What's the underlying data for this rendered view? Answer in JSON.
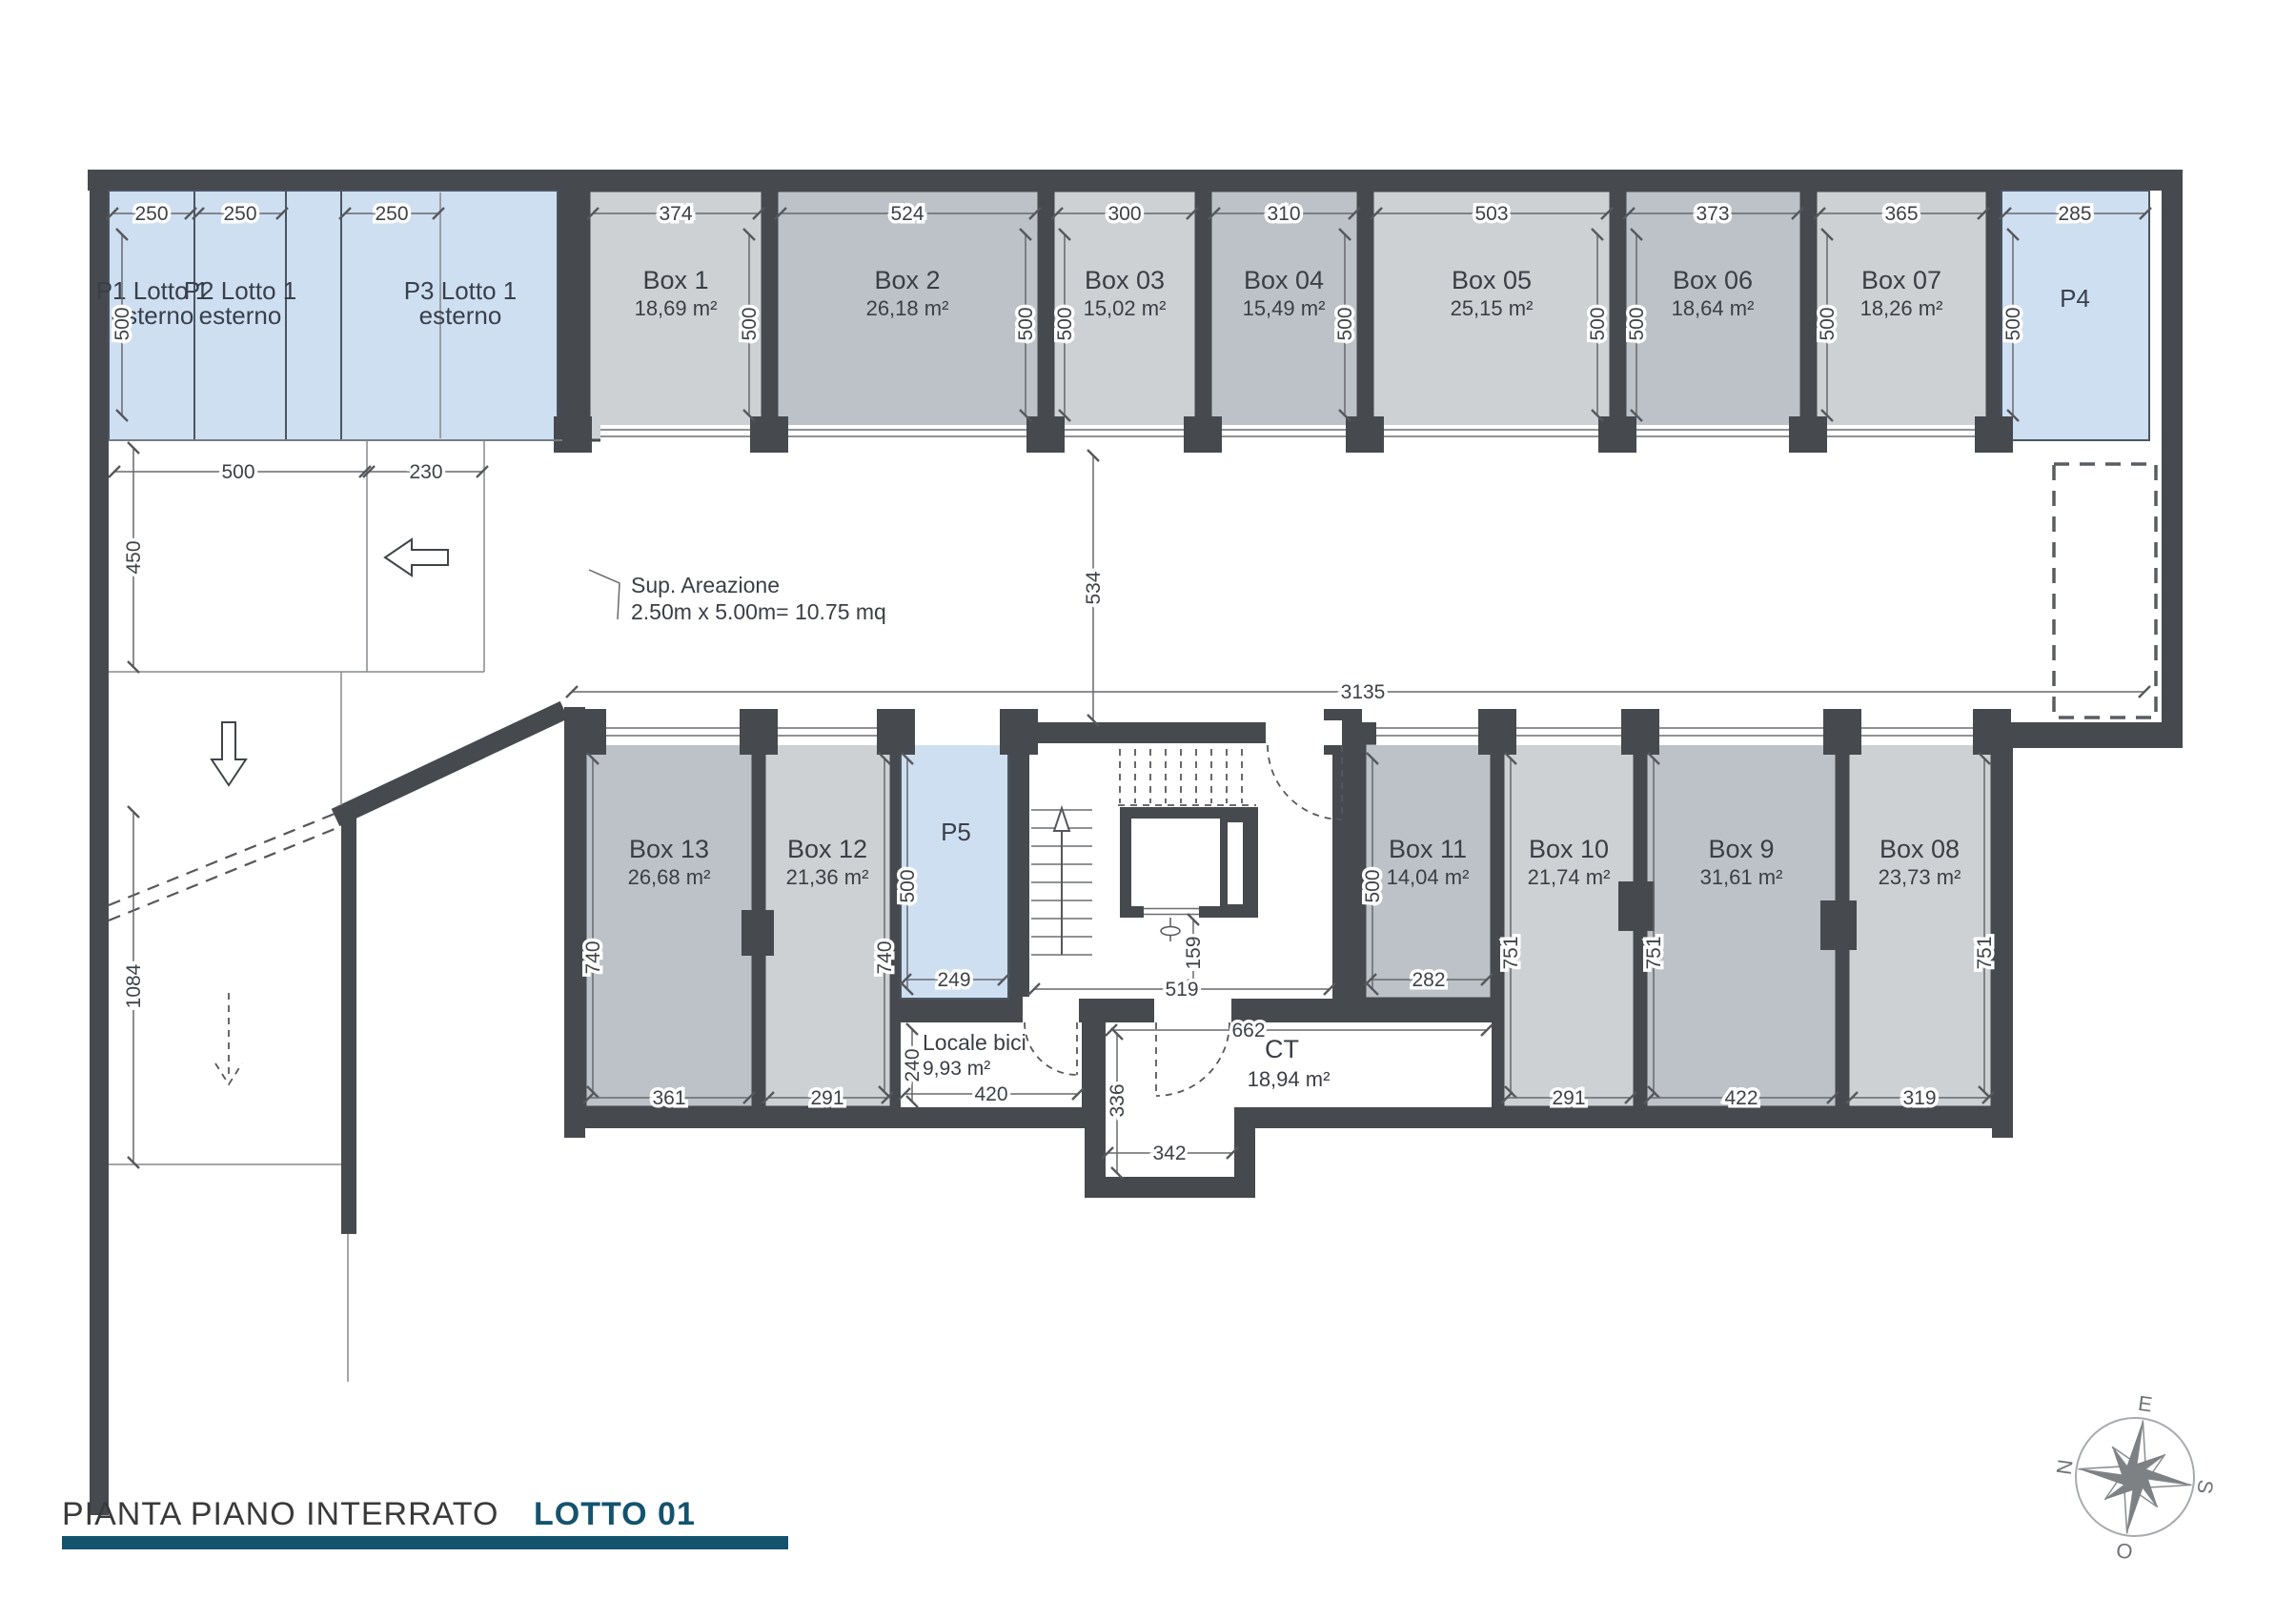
{
  "title": {
    "main": "PIANTA PIANO INTERRATO",
    "lot": "LOTTO 01"
  },
  "annotation": {
    "line1": "Sup. Areazione",
    "line2": "2.50m x 5.00m= 10.75 mq"
  },
  "compass": {
    "e": "E",
    "s": "S",
    "o": "O",
    "n": "N"
  },
  "dims": {
    "top_depth": "500",
    "left_width": "500",
    "left_inner": "230",
    "left_height": "450",
    "ramp_length": "1084",
    "corridor_height": "534",
    "corridor_length": "3135",
    "stair_width": "519",
    "stair_elev": "159"
  },
  "rooms": {
    "top_row": [
      {
        "name": "P1 Lotto 1",
        "line2": "esterno",
        "width": "250"
      },
      {
        "name": "P2 Lotto 1",
        "line2": "esterno",
        "width": "250"
      },
      {
        "name": "P3 Lotto 1",
        "line2": "esterno",
        "width": "250"
      },
      {
        "name": "Box 1",
        "area": "18,69 m²",
        "width": "374"
      },
      {
        "name": "Box 2",
        "area": "26,18 m²",
        "width": "524"
      },
      {
        "name": "Box 03",
        "area": "15,02 m²",
        "width": "300"
      },
      {
        "name": "Box 04",
        "area": "15,49 m²",
        "width": "310"
      },
      {
        "name": "Box  05",
        "area": "25,15 m²",
        "width": "503"
      },
      {
        "name": "Box  06",
        "area": "18,64 m²",
        "width": "373"
      },
      {
        "name": "Box 07",
        "area": "18,26 m²",
        "width": "365"
      },
      {
        "name": "P4",
        "width": "285"
      }
    ],
    "bottom_row": [
      {
        "name": "Box  13",
        "area": "26,68 m²",
        "width": "361",
        "height": "740"
      },
      {
        "name": "Box  12",
        "area": "21,36 m²",
        "width": "291",
        "height": "740"
      },
      {
        "name": "P5",
        "width": "249",
        "height": "500"
      },
      {
        "name": "Box  11",
        "area": "14,04 m²",
        "width": "282",
        "height": "500"
      },
      {
        "name": "Box  10",
        "area": "21,74 m²",
        "width": "291",
        "height": "751"
      },
      {
        "name": "Box 9",
        "area": "31,61 m²",
        "width": "422",
        "height": "751"
      },
      {
        "name": "Box 08",
        "area": "23,73 m²",
        "width": "319",
        "height": "751"
      }
    ],
    "service": [
      {
        "name": "Locale bici",
        "area": "9,93 m²",
        "width": "420",
        "height": "240"
      },
      {
        "name": "CT",
        "area": "18,94 m²",
        "width": "662",
        "height": "336",
        "niche": "342"
      }
    ]
  }
}
